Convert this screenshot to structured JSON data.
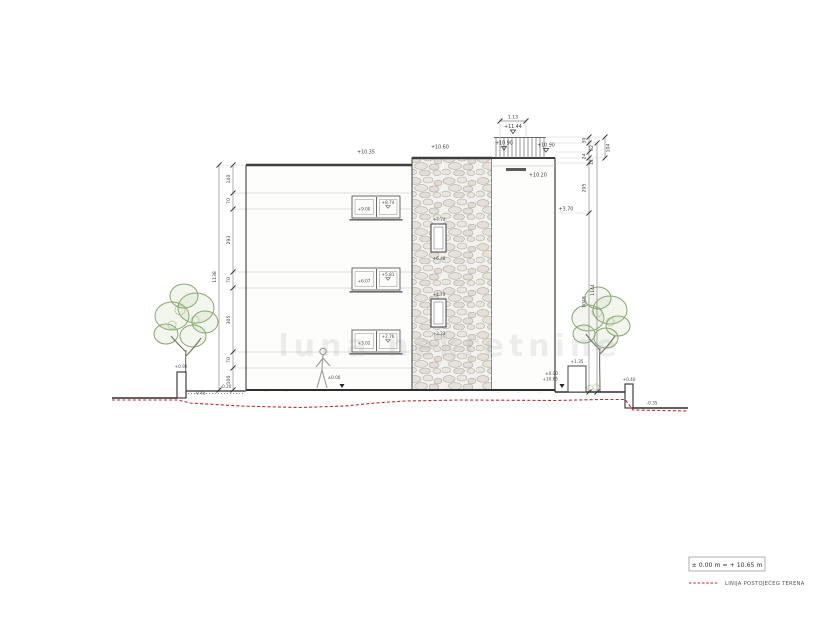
{
  "watermark": "luna nekretnine",
  "legend": {
    "datum": "± 0.00 m = + 10.65 m",
    "terrain_label": "LINIJA POSTOJEĆEG TERENA"
  },
  "top": {
    "railing_width_dim": "1.13",
    "railing_level": "+11.44",
    "parapet_level_left": "+10.90",
    "parapet_level_right": "+10.90",
    "roof_left_level": "+10.35",
    "stone_parapet_level": "+10.60",
    "terrace_level": "+10.20"
  },
  "left_dim": {
    "segments": [
      "140",
      "70",
      "293",
      "70",
      "305",
      "70",
      "100"
    ],
    "total": "1138"
  },
  "right_dim": {
    "segments": [
      "30",
      "62",
      "24",
      "14",
      "295",
      "1048"
    ],
    "total": "1144",
    "aux": "104",
    "level_370": "+3.70"
  },
  "windows": {
    "band1_left": "+9.00",
    "band1_right": "+8.74",
    "band2_left": "+6.07",
    "band2_right": "+5.81",
    "band3_left": "+3.02",
    "band3_right": "+2.76",
    "stone1_top": "+7.74",
    "stone1_bottom": "+6.48",
    "stone2_top": "+4.79",
    "stone2_bottom": "+3.23"
  },
  "ground": {
    "left_wall_top": "+0.90",
    "left_grade": "-0.45",
    "left_step": "-0.20",
    "entry_marker": "±0.00",
    "right_box_top": "+1.35",
    "right_marker_top": "±0.00",
    "right_marker_bottom": "+10.65",
    "right_wall_top": "+0.40",
    "right_grade": "-0.35"
  }
}
